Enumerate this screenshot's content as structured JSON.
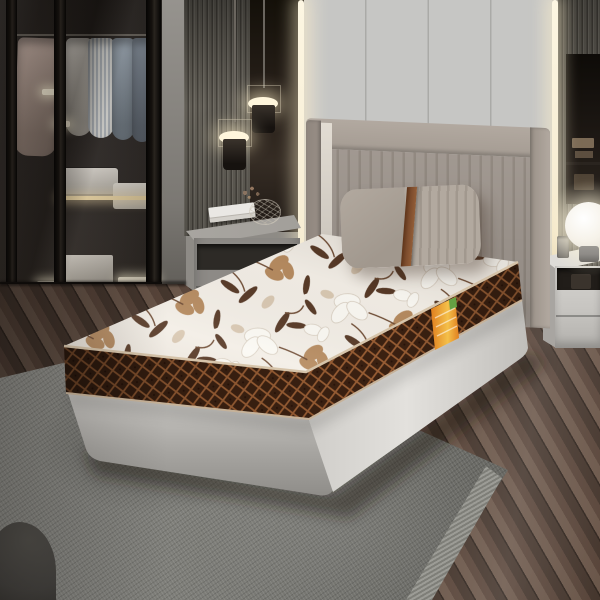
{
  "scene": {
    "title": "Bedroom product render of floral single mattress on platform bed",
    "objects": {
      "wardrobe": "smoked-glass sliding wardrobe with hanging shirts, folded towels and lit drawers",
      "pendant_lights": "two cylindrical pendant lamps on thin cables",
      "wall": "light gray wall panels flanked by warm LED strips and slatted wood panels",
      "headboard": "channel-tufted taupe upholstered headboard with side wings",
      "pillow": "taupe pillow, half smooth half pleated, with brown leather strap",
      "mattress": "white and brown floral-print mattress with dark brown quilted diamond border and piping",
      "label": "orange brand tag on mattress side",
      "bed_base": "light gray platform bed base",
      "left_nightstand": "gray nightstand with white books, wire bowl and dried flowers",
      "right_nightstand": "white nightstand with glass globe lamp and metal cup",
      "rug": "gray woven area rug with frayed edge",
      "floor": "glossy dark brown wood plank floor",
      "pouf": "dark gray pouf corner at bottom left"
    },
    "colors": {
      "wall_panel": "#c6c6c4",
      "wall_panel_dark": "#a8a8a6",
      "led_glow": "#f6ecd2",
      "gray_wall": "#96938e",
      "slat": "#6e6a61",
      "slat_dark": "#4e4a43",
      "slat_hi": "#7d7970",
      "dark_panel": "#241e19",
      "frame_black": "#15110e",
      "shirt_pink": "#b4a096",
      "shirt_white": "#cfcac2",
      "shirt_stripe_a": "#aab0b6",
      "shirt_stripe_b": "#d8d8d4",
      "shirt_blue": "#8e99a4",
      "shirt_blue2": "#76808c",
      "towel_white": "#ded9d1",
      "warm_light": "#f3dca8",
      "headboard": "#aba29a",
      "headboard_rib": "#9b9289",
      "headboard_rail": "#b2a9a0",
      "headboard_wing": "#998f87",
      "headboard_hi": "#e2dcd3",
      "pillow_a": "#b2a99f",
      "pillow_b": "#a1988e",
      "strap": "#7c4c2d",
      "mattress_bg": "#f3eee6",
      "floral_white": "#fbf9f3",
      "floral_outline": "#d8cec0",
      "floral_tan": "#b68b60",
      "floral_brown": "#583a27",
      "floral_stem": "#6f4c34",
      "floral_beige": "#d9c8b2",
      "border_brown": "#3d2212",
      "lattice": "#9e6136",
      "lattice_dot": "#2a1309",
      "piping": "#d6c4aa",
      "piping2": "#c6b299",
      "label_orange": "#e07f1f",
      "label_yellow": "#f4c04a",
      "label_green": "#64a043",
      "base_light": "#e3e1dd",
      "base_mid": "#cfcdc9",
      "base_dark": "#a9a7a3",
      "rug": "#7b7b76",
      "rug_dark": "#5b5b56",
      "rug_hi": "#8f8f8a",
      "rug_edge": "#9c9c96",
      "floor_mid": "#5b473c",
      "floor_light": "#6d594c",
      "floor_dark": "#47382f",
      "floor_gap": "#332821",
      "pouf": "#454340",
      "nstand_l": "#8d8a86",
      "nstand_l_top": "#b4b1ac",
      "nstand_gap": "#2d2a26",
      "nstand_r": "#c6c4c0",
      "nstand_r_top": "#dedcd8",
      "lamp_core": "#ffffff",
      "lamp_edge": "#e9e4da",
      "lamp_base": "#8f8c88",
      "book_white": "#eae8e4"
    }
  }
}
